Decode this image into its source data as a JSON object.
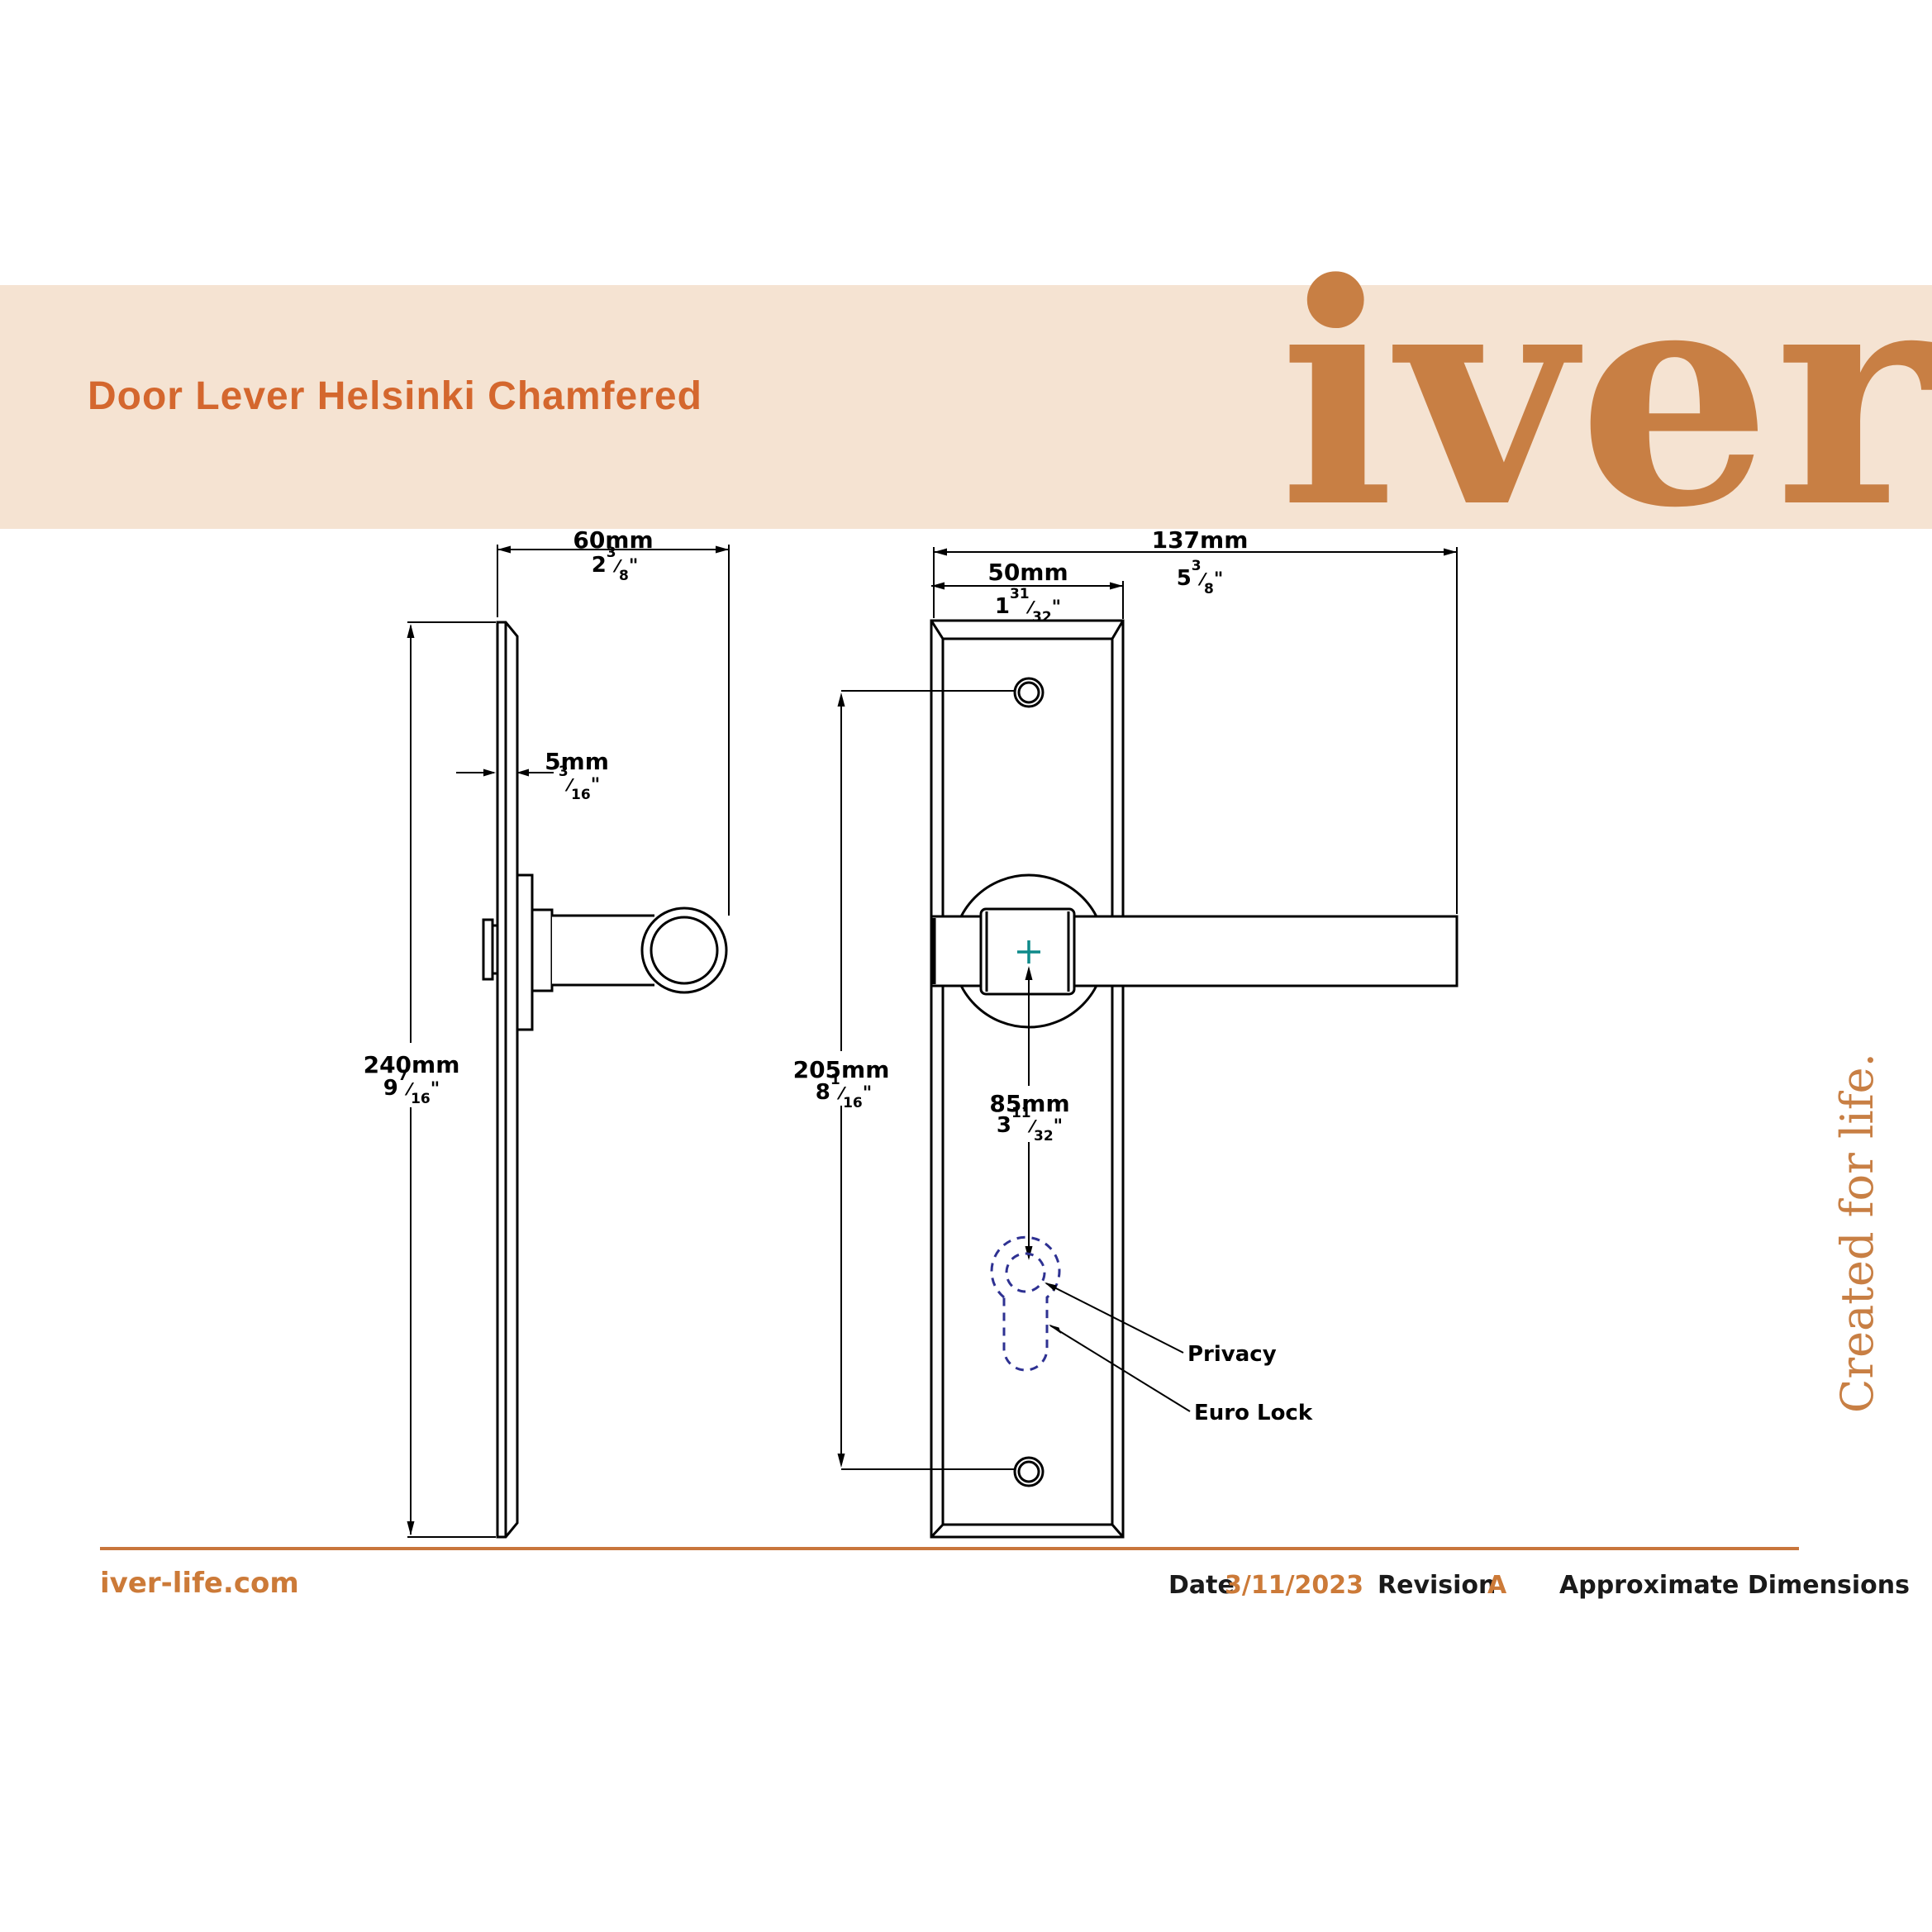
{
  "header": {
    "title": "Door Lever Helsinki Chamfered",
    "logo_text": "iver",
    "banner_color": "#f5e3d2",
    "title_color": "#d4672e",
    "logo_color": "#c87f44"
  },
  "tagline": "Created for life.",
  "dims": {
    "d60": {
      "mm": "60mm",
      "whole": "2",
      "num": "3",
      "den": "8"
    },
    "d5": {
      "mm": "5mm",
      "whole": "",
      "num": "3",
      "den": "16"
    },
    "d240": {
      "mm": "240mm",
      "whole": "9",
      "num": "7",
      "den": "16"
    },
    "d137": {
      "mm": "137mm",
      "whole": "5",
      "num": "3",
      "den": "8"
    },
    "d50": {
      "mm": "50mm",
      "whole": "1",
      "num": "31",
      "den": "32"
    },
    "d205": {
      "mm": "205mm",
      "whole": "8",
      "num": "1",
      "den": "16"
    },
    "d85": {
      "mm": "85mm",
      "whole": "3",
      "num": "11",
      "den": "32"
    }
  },
  "punct": {
    "slash": "⁄",
    "inch": "\""
  },
  "annotations": {
    "privacy": "Privacy",
    "euro_lock": "Euro Lock"
  },
  "footer": {
    "website": "iver-life.com",
    "date_label": "Date",
    "date_value": "3/11/2023",
    "revision_label": "Revision",
    "revision_value": "A",
    "note": "Approximate Dimensions"
  },
  "colors": {
    "accent_orange": "#c8763c",
    "text_orange": "#cc7a38",
    "keyhole_blue": "#2e3192",
    "cross_teal": "#0e8a8a",
    "line_black": "#000000"
  }
}
